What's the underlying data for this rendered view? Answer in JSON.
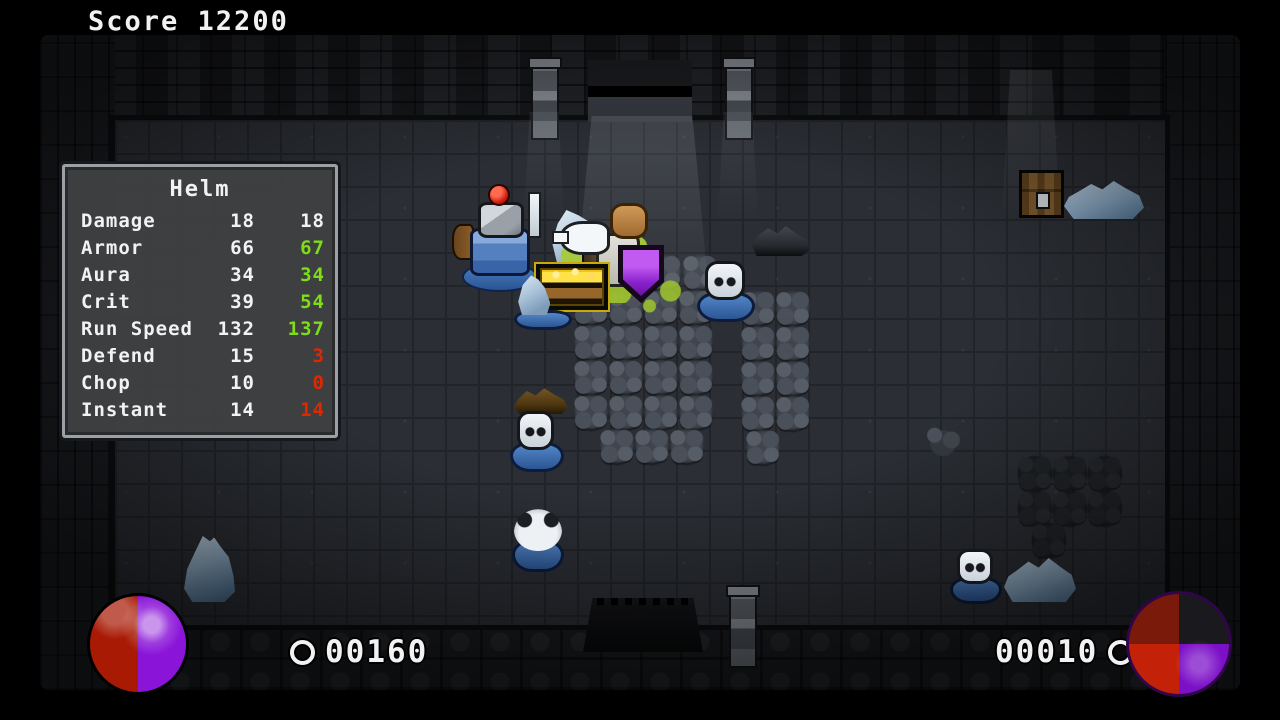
{
  "hud": {
    "score_label": "Score",
    "score_value": "12200",
    "left_counter": "00160",
    "right_counter": "00010"
  },
  "panel": {
    "title": "Helm",
    "rows": [
      {
        "label": "Damage",
        "current": "18",
        "next": "18",
        "state": "same"
      },
      {
        "label": "Armor",
        "current": "66",
        "next": "67",
        "state": "up"
      },
      {
        "label": "Aura",
        "current": "34",
        "next": "34",
        "state": "up"
      },
      {
        "label": "Crit",
        "current": "39",
        "next": "54",
        "state": "up"
      },
      {
        "label": "Run Speed",
        "current": "132",
        "next": "137",
        "state": "up"
      },
      {
        "label": "Defend",
        "current": "15",
        "next": "3",
        "state": "down"
      },
      {
        "label": "Chop",
        "current": "10",
        "next": "0",
        "state": "down"
      },
      {
        "label": "Instant",
        "current": "14",
        "next": "14",
        "state": "down"
      }
    ]
  },
  "colors": {
    "stat_up": "#7fdd16",
    "stat_down": "#e02800",
    "stat_neutral": "#f2f2f2",
    "pie_red": "#a81a04",
    "pie_purple": "#8a14d8",
    "enemy_base_blue": "#3a6db8",
    "floor": "#2b2e34",
    "wall": "#1a1c20"
  },
  "entities": [
    {
      "type": "light-shaft wide",
      "name": "light-shaft-top-door",
      "x": 572,
      "y": 116,
      "w": 140,
      "h": 210
    },
    {
      "type": "light-shaft wide",
      "name": "light-shaft-top-right",
      "x": 1002,
      "y": 70,
      "w": 58,
      "h": 148
    },
    {
      "type": "light-shaft narrow",
      "name": "light-shaft-left-fixture",
      "x": 524,
      "y": 112,
      "w": 40,
      "h": 110
    },
    {
      "type": "light-shaft narrow",
      "name": "light-shaft-right-fixture",
      "x": 718,
      "y": 112,
      "w": 40,
      "h": 110
    },
    {
      "type": "rubble-boat",
      "x": 752,
      "y": 222,
      "w": 58,
      "h": 34
    },
    {
      "type": "debris-brown",
      "x": 514,
      "y": 386,
      "w": 54,
      "h": 28
    },
    {
      "type": "chest-closed",
      "x": 1019,
      "y": 170,
      "w": 45,
      "h": 48
    },
    {
      "type": "ice-flat",
      "x": 1064,
      "y": 181,
      "w": 80,
      "h": 38
    },
    {
      "type": "ice-flat",
      "x": 1004,
      "y": 558,
      "w": 72,
      "h": 44
    },
    {
      "type": "ice-pile",
      "x": 183,
      "y": 536,
      "w": 52,
      "h": 66
    },
    {
      "type": "drips",
      "x": 598,
      "y": 252,
      "w": 44,
      "h": 52
    },
    {
      "type": "knight",
      "x": 452,
      "y": 188,
      "w": 95,
      "h": 102,
      "parts": [
        "k-puddle",
        "k-shield",
        "k-armor",
        "k-helm",
        "k-plume",
        "k-sword"
      ]
    },
    {
      "type": "ice-small",
      "x": 552,
      "y": 210,
      "w": 48,
      "h": 52
    },
    {
      "type": "hero",
      "x": 558,
      "y": 203,
      "w": 100,
      "h": 112,
      "parts": [
        "h-splash-a",
        "h-splash-b",
        "h-pole",
        "h-torso",
        "h-hair",
        "h-duck",
        "h-beak",
        "h-badge",
        "h-badge-inner"
      ]
    },
    {
      "type": "gold-chest",
      "x": 536,
      "y": 264,
      "w": 72,
      "h": 46
    },
    {
      "type": "puddle-ice",
      "x": 512,
      "y": 288,
      "w": 62,
      "h": 42
    },
    {
      "type": "skull-enemy",
      "x": 695,
      "y": 260,
      "w": 62,
      "h": 62
    },
    {
      "type": "skull-enemy",
      "x": 508,
      "y": 410,
      "w": 58,
      "h": 62
    },
    {
      "type": "bird-enemy",
      "x": 510,
      "y": 506,
      "w": 56,
      "h": 66
    },
    {
      "type": "skull-enemy",
      "x": 948,
      "y": 548,
      "w": 56,
      "h": 56
    },
    {
      "type": "rubble-small",
      "x": 922,
      "y": 424,
      "w": 42,
      "h": 32
    }
  ],
  "statues": [
    [
      588,
      253
    ],
    [
      645,
      253
    ],
    [
      681,
      253
    ],
    [
      572,
      288
    ],
    [
      607,
      288
    ],
    [
      642,
      288
    ],
    [
      677,
      288
    ],
    [
      572,
      323
    ],
    [
      607,
      323
    ],
    [
      642,
      323
    ],
    [
      677,
      323
    ],
    [
      572,
      358
    ],
    [
      607,
      358
    ],
    [
      642,
      358
    ],
    [
      677,
      358
    ],
    [
      572,
      393
    ],
    [
      607,
      393
    ],
    [
      642,
      393
    ],
    [
      677,
      393
    ],
    [
      598,
      427
    ],
    [
      633,
      427
    ],
    [
      668,
      427
    ],
    [
      739,
      289
    ],
    [
      774,
      289
    ],
    [
      739,
      324
    ],
    [
      774,
      324
    ],
    [
      739,
      359
    ],
    [
      774,
      359
    ],
    [
      739,
      394
    ],
    [
      774,
      394
    ],
    [
      744,
      428
    ],
    [
      1016,
      454,
      1
    ],
    [
      1051,
      454,
      1
    ],
    [
      1086,
      454,
      1
    ],
    [
      1016,
      489,
      1
    ],
    [
      1051,
      489,
      1
    ],
    [
      1086,
      489,
      1
    ],
    [
      1030,
      521,
      1
    ]
  ]
}
